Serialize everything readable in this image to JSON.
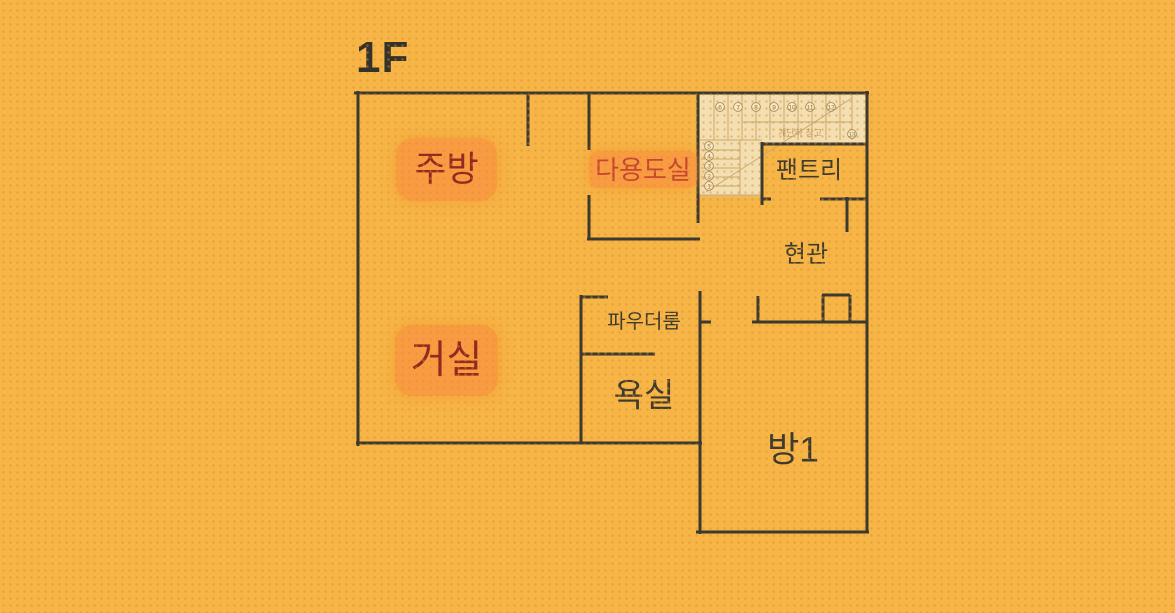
{
  "page": {
    "background_color": "#f6b546",
    "dot_texture_color": "#d8902a"
  },
  "floor_title": "1F",
  "floorplan": {
    "wall_color": "#3c392e",
    "highlight_color": "#f99b42",
    "plain_label_color": "#3f3b2f",
    "rooms": [
      {
        "id": "kitchen",
        "label": "주방",
        "highlighted": true,
        "label_color": "#93291f"
      },
      {
        "id": "utility-room",
        "label": "다용도실",
        "highlighted": true,
        "label_color": "#c8452f"
      },
      {
        "id": "pantry",
        "label": "팬트리",
        "highlighted": false,
        "label_color": "#3f3b2f"
      },
      {
        "id": "entrance",
        "label": "현관",
        "highlighted": false,
        "label_color": "#3f3b2f"
      },
      {
        "id": "powder-room",
        "label": "파우더룸",
        "highlighted": false,
        "label_color": "#3f3b2f"
      },
      {
        "id": "living-room",
        "label": "거실",
        "highlighted": true,
        "label_color": "#93291f"
      },
      {
        "id": "bathroom",
        "label": "욕실",
        "highlighted": false,
        "label_color": "#3f3b2f"
      },
      {
        "id": "room1",
        "label": "방1",
        "highlighted": false,
        "label_color": "#3f3b2f"
      }
    ],
    "stairs": {
      "note": "계단하 창고",
      "step_numbers": [
        "1",
        "2",
        "3",
        "4",
        "5",
        "6",
        "7",
        "8",
        "9",
        "10",
        "11",
        "12",
        "13"
      ],
      "fill_color": "#f4dfb2",
      "line_color": "#c9aa6e"
    }
  }
}
